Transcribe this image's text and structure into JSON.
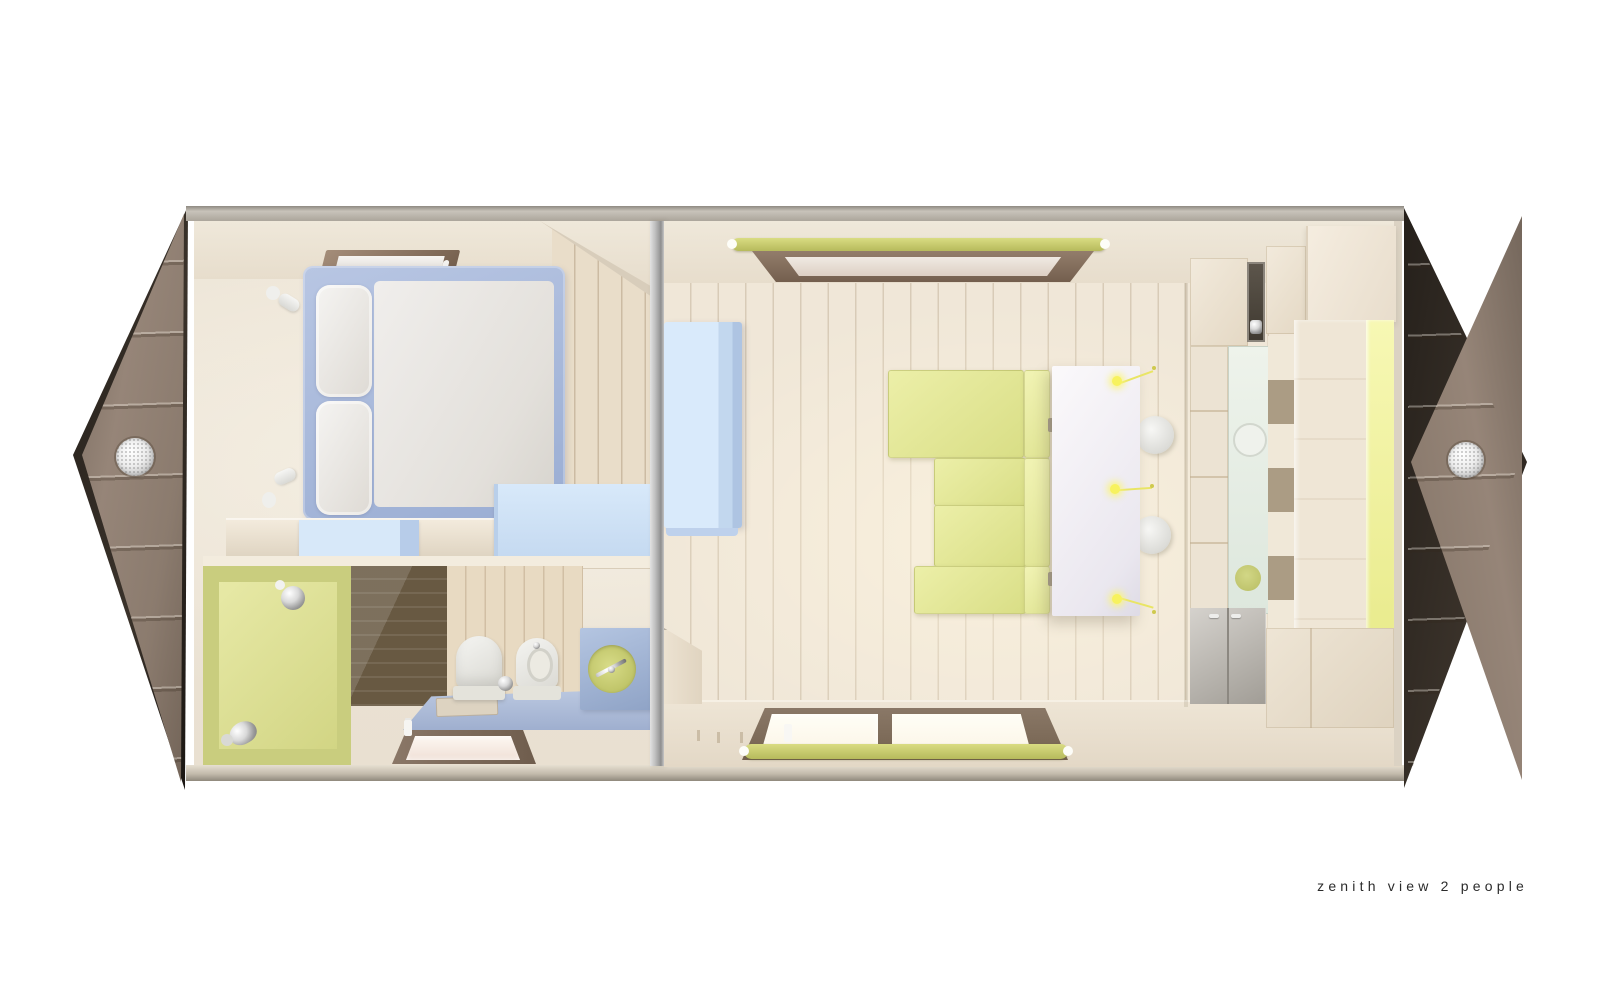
{
  "caption": {
    "text": "zenith view 2 people"
  },
  "palette": {
    "prow": "#968578",
    "prowDark": "#241f1a",
    "cream": "#ece4d6",
    "woodFloor": "#f0e7d8",
    "periwinkle": "#a8b9d9",
    "mattress": "#eceae6",
    "blueLight": "#d6e7f8",
    "bathFloorBlue": "#aebcd8",
    "vanityBlue": "#9fb4d6",
    "showerGreen": "#d6d98c",
    "sinkGreen": "#c5ca6e",
    "sofaGreen": "#e2e693",
    "tableWhite": "#f2eff5",
    "blindGreen": "#c9cd6e",
    "frameBrown": "#82705f",
    "yellowStrip": "#f0f2a2",
    "grayCabinet": "#b5b1aa",
    "divider": "#b9b9b9",
    "captionColor": "#2b2b2b"
  },
  "scene": {
    "type": "3d-architectural-floor-plan-render",
    "rooms": [
      {
        "name": "bedroom",
        "objects": [
          "double-bed",
          "two-pillows",
          "skylight",
          "wall-spotlight",
          "wall-spotlight",
          "counter",
          "blue-nightstand",
          "blue-cabinet"
        ]
      },
      {
        "name": "bathroom",
        "objects": [
          "green-shower",
          "shower-head",
          "hand-sprayer",
          "dark-wood-shower-floor",
          "toilet",
          "bidet",
          "vanity-with-round-sink",
          "floor-platform",
          "bath-mat",
          "small-window"
        ]
      },
      {
        "name": "living-room",
        "objects": [
          "corner-sofa",
          "dining-table",
          "round-chair",
          "round-chair",
          "pendant-light",
          "pendant-light",
          "pendant-light",
          "roof-window-with-blind",
          "double-window-with-blind",
          "blue-wardrobe"
        ]
      },
      {
        "name": "kitchen-storage-wall",
        "objects": [
          "upper-cabinets",
          "dark-glass-door",
          "tall-column",
          "glass-display-cabinet",
          "plates",
          "open-shelves",
          "wood-counter",
          "yellow-bench-cushion",
          "gray-base-cabinet",
          "wood-base-cabinet"
        ]
      }
    ],
    "shell": {
      "ends": [
        "left-prow-with-porthole",
        "right-prow-with-porthole"
      ],
      "partition": "central-divider-wall"
    }
  }
}
